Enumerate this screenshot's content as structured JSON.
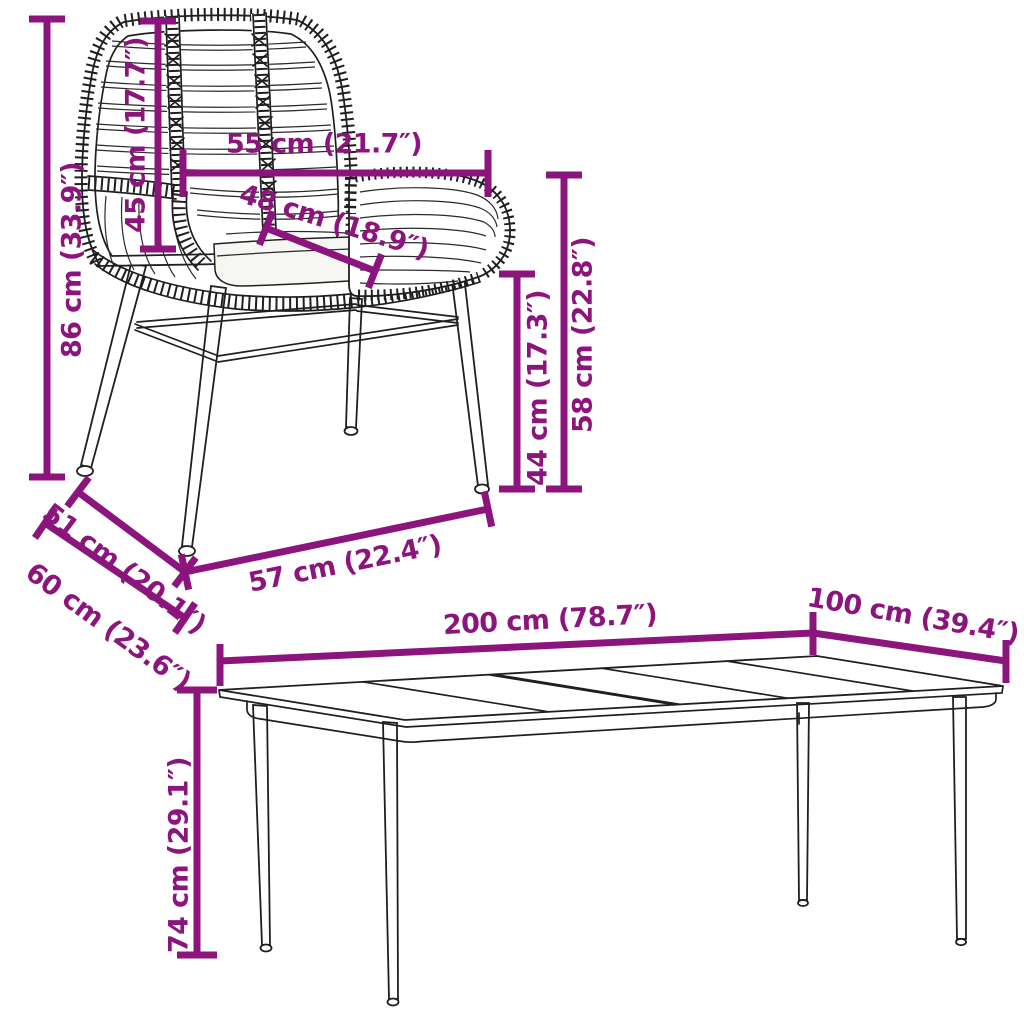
{
  "diagram": {
    "background": "#ffffff",
    "accent_color": "#8C157D",
    "line_color": "#1f1f1f",
    "cushion_color": "#f6f6f2"
  },
  "chair": {
    "dimensions": {
      "total_height": "86 cm (33.9″)",
      "backrest_height": "45 cm (17.7″)",
      "total_width": "55 cm (21.7″)",
      "seat_width": "48 cm (18.9″)",
      "seat_height": "44 cm (17.3″)",
      "armrest_height": "58 cm (22.8″)",
      "seat_depth": "51 cm (20.1″)",
      "total_depth": "60 cm (23.6″)",
      "base_width": "57 cm (22.4″)"
    }
  },
  "table": {
    "dimensions": {
      "length": "200 cm (78.7″)",
      "width": "100 cm (39.4″)",
      "height": "74 cm (29.1″)"
    }
  }
}
